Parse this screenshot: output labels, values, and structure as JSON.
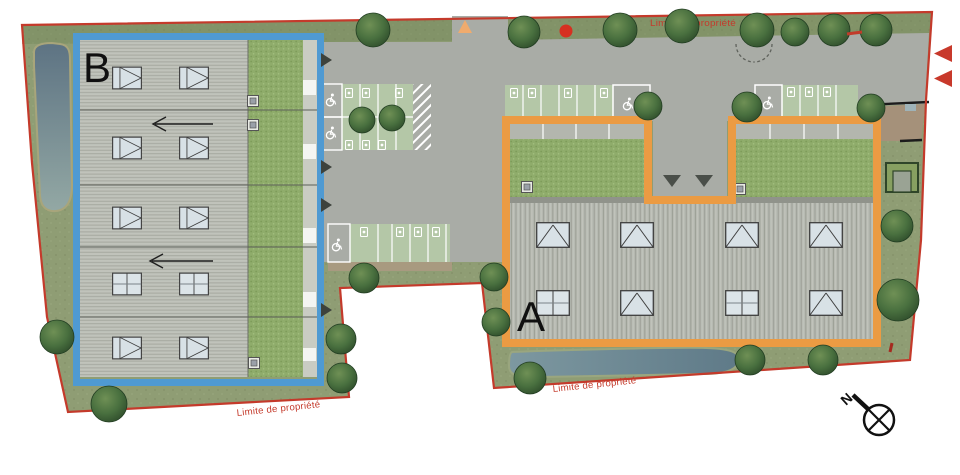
{
  "plan": {
    "labels": {
      "building_a": "A",
      "building_b": "B",
      "north": "N",
      "property_limit": "Limite de propriété"
    },
    "colors": {
      "property_line_red": "#c43a2b",
      "building_b_outline_blue": "#4f9ad2",
      "building_a_outline_orange": "#eb9b43",
      "grass_green": "#8f9d74",
      "courtyard_green": "#8fac6b",
      "roof_gray_b": "#c0c3bb",
      "roof_gray_a": "#b7bab2",
      "pavement_gray": "#a9aca6",
      "parking_grass_green": "#b4c7a7",
      "water_blue_gray": "#6f8b95",
      "tree_green": "#49703f",
      "sidewalk_brown": "#a89a80",
      "entrance_triangle_orange": "#f0ab6d",
      "access_arrow_red": "#c8392b",
      "skylight_glass": "#d8e1e6"
    },
    "icons": {
      "north_compass": "circle-x-with-needle",
      "tree": "dark-green-canopy-circle",
      "ev_charging_space": "white-charger-pictogram",
      "accessible_parking_space": "white-wheelchair-pictogram",
      "skylight_right": "square-with-right-triangle-glyph",
      "skylight_up": "square-with-up-triangle-glyph",
      "skylight_split": "square-with-cross-glyph",
      "roof_vent": "small-gray-square",
      "building_entrance": "dark-gray-triangle",
      "site_entrance_top": "orange-triangle",
      "site_access_right": "red-triangle",
      "gate": "dashed-swing-arcs"
    }
  }
}
